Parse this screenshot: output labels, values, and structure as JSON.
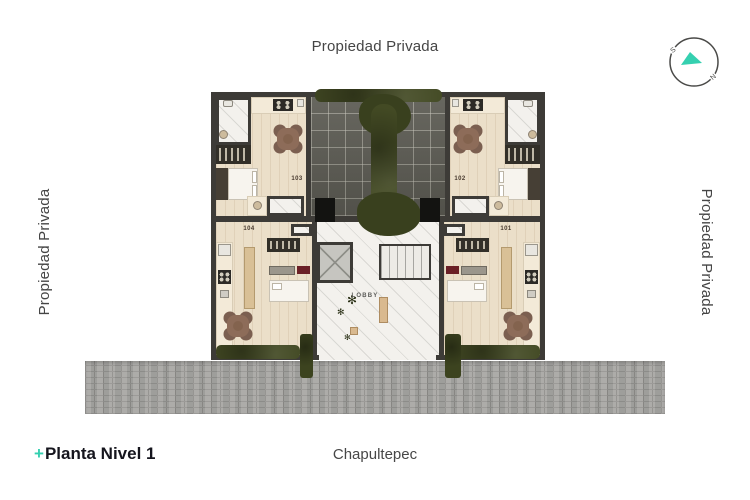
{
  "surroundings": {
    "top": "Propiedad Privada",
    "left": "Propiedad Privada",
    "right": "Propiedad Privada"
  },
  "compass": {
    "south_label": "S",
    "north_label": "N",
    "needle_color": "#35d0b0"
  },
  "plan": {
    "units": [
      {
        "label": "101"
      },
      {
        "label": "102"
      },
      {
        "label": "103"
      },
      {
        "label": "104"
      }
    ],
    "lobby_label": "LOBBY"
  },
  "footer": {
    "title_prefix": "+",
    "title": "Planta Nivel 1",
    "street": "Chapultepec"
  },
  "icons": {
    "plant": "✻"
  },
  "colors": {
    "accent_teal": "#35d0b0",
    "wall": "#3d3b37",
    "hedge_green": "#434a24",
    "street_gray": "#a7a6a3",
    "wood_floor": "#ebdfc9",
    "terrace_tile": "#5f5e56"
  }
}
